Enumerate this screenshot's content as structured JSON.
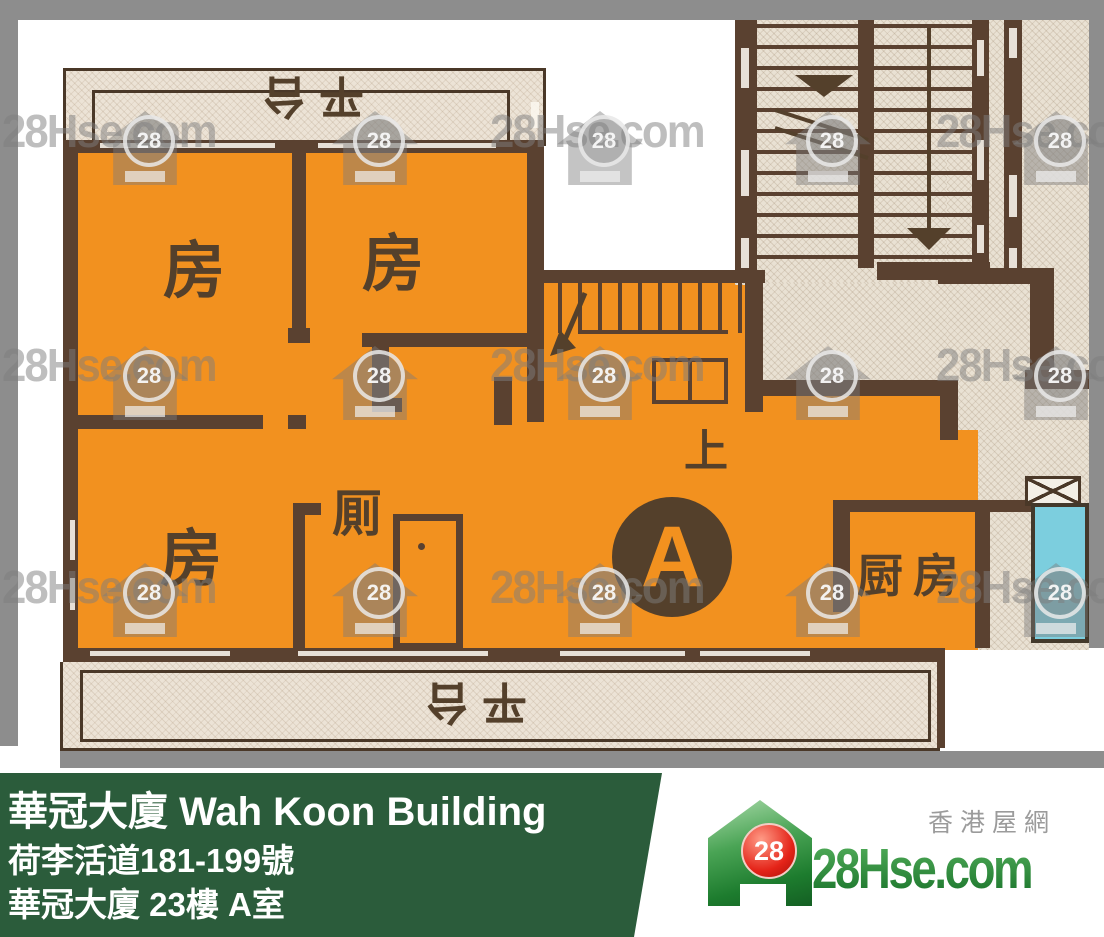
{
  "floorplan": {
    "labels": {
      "terrace_top": "平台",
      "terrace_bottom": "平台",
      "room1": "房",
      "room2": "房",
      "room3": "房",
      "toilet": "厠",
      "kitchen": "厨房",
      "stairs_up": "上",
      "unit_marker": "A"
    },
    "colors": {
      "unit_fill": "#f2911f",
      "wall": "#5a4130",
      "terrace_fill": "#e9e1d3",
      "water_feature": "#7ccede",
      "scan_edge": "#8d8d8d"
    }
  },
  "watermark": {
    "text": "28Hse.com",
    "badge": "28",
    "text_positions": [
      [
        2,
        104
      ],
      [
        490,
        104
      ],
      [
        936,
        104
      ],
      [
        2,
        338
      ],
      [
        490,
        338
      ],
      [
        936,
        338
      ],
      [
        2,
        560
      ],
      [
        490,
        560
      ],
      [
        936,
        560
      ]
    ],
    "icon_positions": [
      [
        145,
        148
      ],
      [
        375,
        148
      ],
      [
        600,
        148
      ],
      [
        828,
        148
      ],
      [
        1056,
        148
      ],
      [
        145,
        383
      ],
      [
        375,
        383
      ],
      [
        600,
        383
      ],
      [
        828,
        383
      ],
      [
        1056,
        383
      ],
      [
        145,
        600
      ],
      [
        375,
        600
      ],
      [
        600,
        600
      ],
      [
        828,
        600
      ],
      [
        1056,
        600
      ]
    ]
  },
  "infobar": {
    "title": "華冠大廈 Wah Koon Building",
    "address": "荷李活道181-199號",
    "unit": "華冠大廈 23樓 A室",
    "bg_color": "#2b5c3b"
  },
  "logo": {
    "badge": "28",
    "site": "28Hse.com",
    "tagline": "香港屋網"
  }
}
